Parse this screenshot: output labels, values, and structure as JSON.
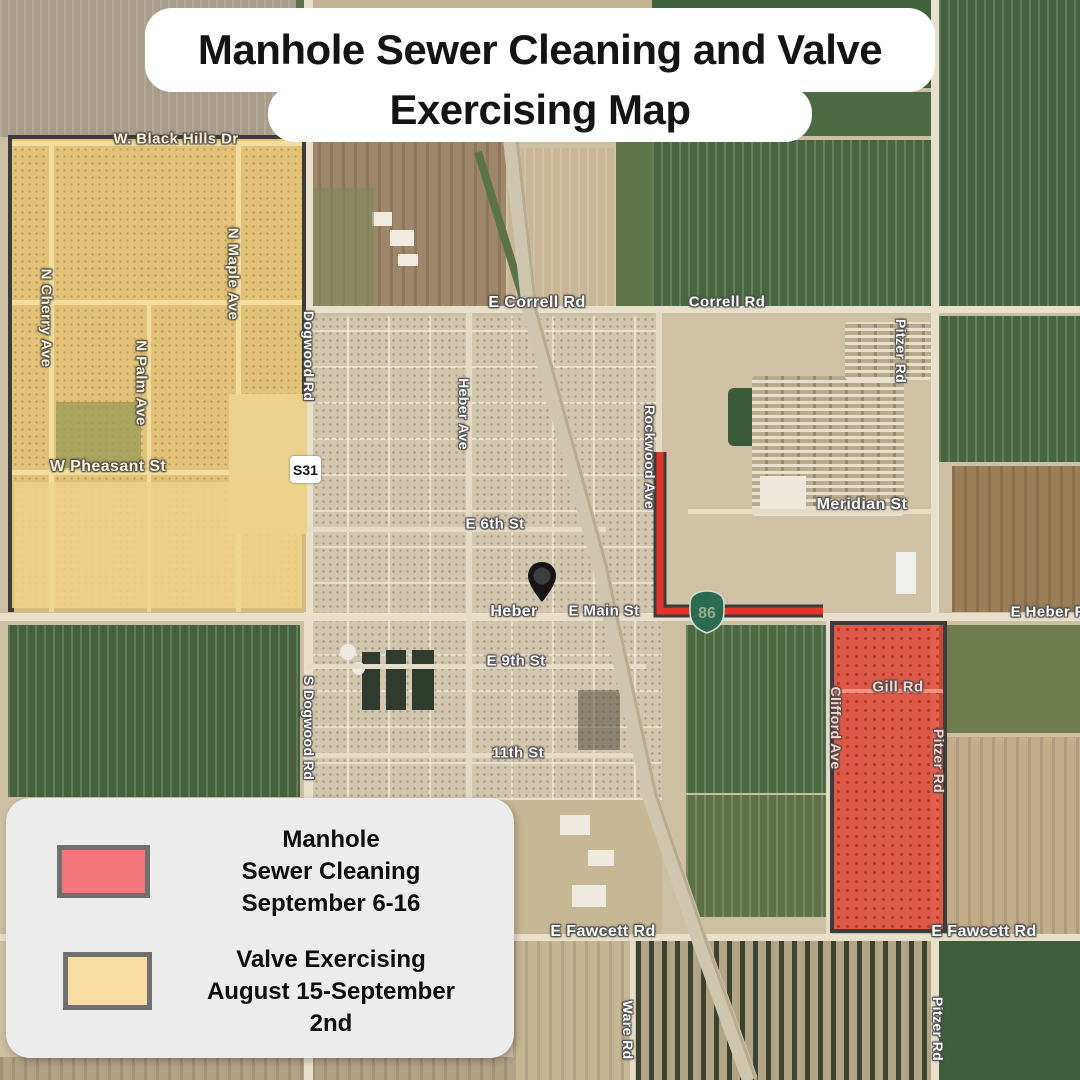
{
  "title": {
    "line1": "Manhole Sewer Cleaning and Valve",
    "line2": "Exercising Map"
  },
  "legend": {
    "items": [
      {
        "label_lines": [
          "Manhole",
          "Sewer Cleaning",
          "September 6-16"
        ],
        "swatch_color": "#f2767b",
        "swatch_border": "#707070"
      },
      {
        "label_lines": [
          "Valve Exercising",
          "August 15-September",
          "2nd"
        ],
        "swatch_color": "#f8dca4",
        "swatch_border": "#707070"
      }
    ]
  },
  "map": {
    "town_name": "Heber",
    "overlays": {
      "sewer_cleaning_area": {
        "fill": "rgba(226,60,45,0.78)",
        "border": "#3c3c3c"
      },
      "valve_exercising_area": {
        "fill": "#e2c178",
        "border": "#3c3c3c"
      },
      "sewer_route_color": "#e2342a"
    },
    "shields": {
      "s31": {
        "text": "S31"
      },
      "ca86": {
        "text": "86"
      }
    },
    "labels": [
      {
        "t": "W. Black Hills Dr",
        "x": 176,
        "y": 139,
        "v": 0,
        "c": "y",
        "s": 15
      },
      {
        "t": "N Cherry Ave",
        "x": 46,
        "y": 318,
        "v": 1,
        "c": "y",
        "s": 15
      },
      {
        "t": "N Maple Ave",
        "x": 233,
        "y": 274,
        "v": 1,
        "c": "y",
        "s": 15
      },
      {
        "t": "N Palm Ave",
        "x": 141,
        "y": 383,
        "v": 1,
        "c": "y",
        "s": 15
      },
      {
        "t": "Dogwood Rd",
        "x": 309,
        "y": 356,
        "v": 1,
        "c": "",
        "s": 14
      },
      {
        "t": "W Pheasant St",
        "x": 108,
        "y": 467,
        "v": 0,
        "c": "y",
        "s": 16
      },
      {
        "t": "E Correll Rd",
        "x": 537,
        "y": 303,
        "v": 0,
        "c": "",
        "s": 16
      },
      {
        "t": "Correll Rd",
        "x": 727,
        "y": 302,
        "v": 0,
        "c": "",
        "s": 15
      },
      {
        "t": "Pitzer Rd",
        "x": 901,
        "y": 351,
        "v": 1,
        "c": "",
        "s": 14
      },
      {
        "t": "Heber Ave",
        "x": 464,
        "y": 414,
        "v": 1,
        "c": "",
        "s": 14
      },
      {
        "t": "Rockwood Ave",
        "x": 650,
        "y": 457,
        "v": 1,
        "c": "",
        "s": 14
      },
      {
        "t": "Meridian St",
        "x": 862,
        "y": 505,
        "v": 0,
        "c": "",
        "s": 16
      },
      {
        "t": "E 6th St",
        "x": 495,
        "y": 524,
        "v": 0,
        "c": "",
        "s": 15
      },
      {
        "t": "Heber",
        "x": 514,
        "y": 612,
        "v": 0,
        "c": "",
        "s": 16
      },
      {
        "t": "E Main St",
        "x": 604,
        "y": 611,
        "v": 0,
        "c": "",
        "s": 15
      },
      {
        "t": "E Heber Rd",
        "x": 1053,
        "y": 612,
        "v": 0,
        "c": "",
        "s": 15
      },
      {
        "t": "E 9th St",
        "x": 516,
        "y": 661,
        "v": 0,
        "c": "",
        "s": 15
      },
      {
        "t": "S Dogwood Rd",
        "x": 309,
        "y": 728,
        "v": 1,
        "c": "",
        "s": 14
      },
      {
        "t": "11th St",
        "x": 518,
        "y": 753,
        "v": 0,
        "c": "",
        "s": 15
      },
      {
        "t": "Gill Rd",
        "x": 898,
        "y": 687,
        "v": 0,
        "c": "r",
        "s": 15
      },
      {
        "t": "Clifford Ave",
        "x": 836,
        "y": 728,
        "v": 1,
        "c": "r",
        "s": 14
      },
      {
        "t": "Pitzer Rd",
        "x": 939,
        "y": 761,
        "v": 1,
        "c": "r",
        "s": 14
      },
      {
        "t": "E Fawcett Rd",
        "x": 603,
        "y": 932,
        "v": 0,
        "c": "",
        "s": 16
      },
      {
        "t": "E Fawcett Rd",
        "x": 984,
        "y": 932,
        "v": 0,
        "c": "",
        "s": 16
      },
      {
        "t": "Ware Rd",
        "x": 628,
        "y": 1030,
        "v": 1,
        "c": "",
        "s": 14
      },
      {
        "t": "Pitzer Rd",
        "x": 938,
        "y": 1029,
        "v": 1,
        "c": "",
        "s": 14
      }
    ]
  }
}
